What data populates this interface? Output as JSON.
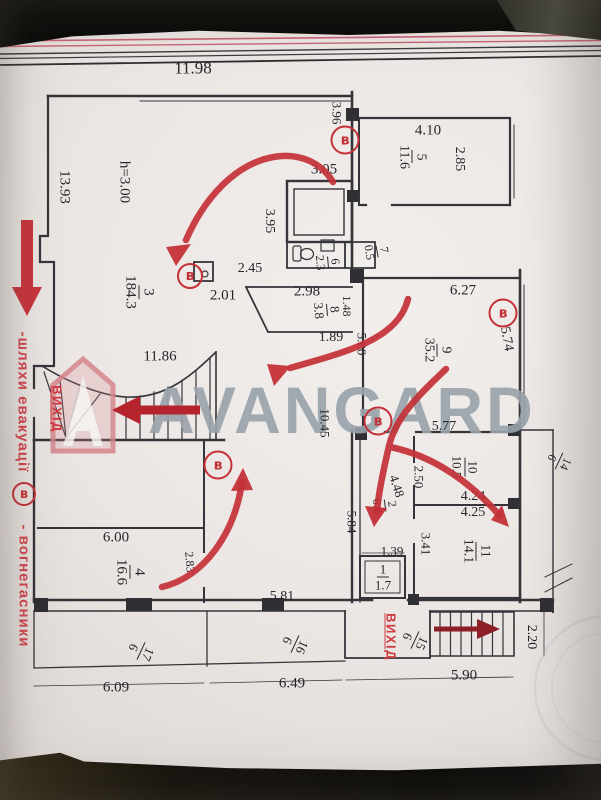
{
  "watermark": {
    "brand": "AVANGARD"
  },
  "legend": {
    "route_label": "-шляхи  евакуації",
    "extinguisher_symbol": "в",
    "extinguisher_label": "- вогнегасники"
  },
  "exit_labels": [
    {
      "text": "ВИХІД",
      "x": 57,
      "y": 409,
      "r": 90,
      "fs": 13
    },
    {
      "text": "ВИХІД",
      "x": 391,
      "y": 637,
      "r": 90,
      "fs": 13
    }
  ],
  "extinguisher_marks": [
    {
      "symbol": "в",
      "x": 345,
      "y": 140,
      "d": 25
    },
    {
      "symbol": "в",
      "x": 190,
      "y": 276,
      "d": 22
    },
    {
      "symbol": "в",
      "x": 503,
      "y": 313,
      "d": 25
    },
    {
      "symbol": "в",
      "x": 378,
      "y": 421,
      "d": 25
    },
    {
      "symbol": "в",
      "x": 218,
      "y": 465,
      "d": 25
    }
  ],
  "room_labels": [
    {
      "num": "1",
      "area": "1.7",
      "x": 383,
      "y": 577,
      "r": 0,
      "fs": 13
    },
    {
      "num": "2",
      "area": "6.2",
      "x": 385,
      "y": 505,
      "r": 82,
      "fs": 12
    },
    {
      "num": "3",
      "area": "184.3",
      "x": 139,
      "y": 292,
      "r": 90,
      "fs": 15
    },
    {
      "num": "4",
      "area": "16.6",
      "x": 130,
      "y": 572,
      "r": 90,
      "fs": 15
    },
    {
      "num": "5",
      "area": "11.6",
      "x": 412,
      "y": 157,
      "r": 90,
      "fs": 14
    },
    {
      "num": "6",
      "area": "2.3",
      "x": 328,
      "y": 262,
      "r": 85,
      "fs": 12
    },
    {
      "num": "7",
      "area": "0.5",
      "x": 377,
      "y": 251,
      "r": 80,
      "fs": 12
    },
    {
      "num": "8",
      "area": "3.8",
      "x": 327,
      "y": 310,
      "r": 85,
      "fs": 13
    },
    {
      "num": "9",
      "area": "35.2",
      "x": 437,
      "y": 350,
      "r": 90,
      "fs": 14
    },
    {
      "num": "10",
      "area": "10.5",
      "x": 465,
      "y": 467,
      "r": 90,
      "fs": 13
    },
    {
      "num": "11",
      "area": "14.1",
      "x": 476,
      "y": 551,
      "r": 90,
      "fs": 14
    },
    {
      "num": "14",
      "area": "6",
      "x": 559,
      "y": 461,
      "r": 115,
      "fs": 12
    },
    {
      "num": "15",
      "area": "6",
      "x": 415,
      "y": 640,
      "r": 115,
      "fs": 13
    },
    {
      "num": "16",
      "area": "6",
      "x": 295,
      "y": 644,
      "r": 115,
      "fs": 13
    },
    {
      "num": "17",
      "area": "6",
      "x": 141,
      "y": 651,
      "r": 115,
      "fs": 13
    }
  ],
  "dimensions": [
    {
      "text": "11.98",
      "x": 193,
      "y": 68,
      "r": 0,
      "fs": 17
    },
    {
      "text": "3.96",
      "x": 337,
      "y": 113,
      "r": 90,
      "fs": 13
    },
    {
      "text": "4.10",
      "x": 428,
      "y": 131,
      "r": 0,
      "fs": 15
    },
    {
      "text": "2.85",
      "x": 459,
      "y": 159,
      "r": 90,
      "fs": 14
    },
    {
      "text": "3.05",
      "x": 324,
      "y": 170,
      "r": 0,
      "fs": 15
    },
    {
      "text": "3.95",
      "x": 269,
      "y": 221,
      "r": 90,
      "fs": 14
    },
    {
      "text": "13.93",
      "x": 64,
      "y": 187,
      "r": 90,
      "fs": 15
    },
    {
      "text": "h=3.00",
      "x": 124,
      "y": 182,
      "r": 90,
      "fs": 15
    },
    {
      "text": "2.45",
      "x": 250,
      "y": 269,
      "r": 0,
      "fs": 14
    },
    {
      "text": "2.01",
      "x": 223,
      "y": 296,
      "r": 0,
      "fs": 15
    },
    {
      "text": "2.98",
      "x": 307,
      "y": 292,
      "r": 0,
      "fs": 15
    },
    {
      "text": "1.48",
      "x": 347,
      "y": 306,
      "r": 90,
      "fs": 12
    },
    {
      "text": "1.89",
      "x": 331,
      "y": 338,
      "r": 0,
      "fs": 14
    },
    {
      "text": "5.00",
      "x": 362,
      "y": 344,
      "r": 90,
      "fs": 13
    },
    {
      "text": "6.27",
      "x": 463,
      "y": 291,
      "r": 0,
      "fs": 15
    },
    {
      "text": "5.74",
      "x": 506,
      "y": 339,
      "r": 80,
      "fs": 14
    },
    {
      "text": "11.86",
      "x": 160,
      "y": 357,
      "r": 0,
      "fs": 15
    },
    {
      "text": "10.45",
      "x": 325,
      "y": 423,
      "r": 90,
      "fs": 13
    },
    {
      "text": "5.77",
      "x": 444,
      "y": 427,
      "r": 0,
      "fs": 14
    },
    {
      "text": "2.50",
      "x": 419,
      "y": 477,
      "r": 90,
      "fs": 13
    },
    {
      "text": "4.48",
      "x": 397,
      "y": 486,
      "r": 72,
      "fs": 13
    },
    {
      "text": "4.24",
      "x": 473,
      "y": 497,
      "r": 0,
      "fs": 14
    },
    {
      "text": "4.25",
      "x": 473,
      "y": 513,
      "r": 0,
      "fs": 14
    },
    {
      "text": "3.41",
      "x": 426,
      "y": 544,
      "r": 90,
      "fs": 13
    },
    {
      "text": "5.84",
      "x": 352,
      "y": 522,
      "r": 90,
      "fs": 13
    },
    {
      "text": "6.00",
      "x": 116,
      "y": 538,
      "r": 0,
      "fs": 15
    },
    {
      "text": "2.83",
      "x": 190,
      "y": 562,
      "r": 85,
      "fs": 12
    },
    {
      "text": "1.39",
      "x": 392,
      "y": 551,
      "r": 0,
      "fs": 13
    },
    {
      "text": "5.81",
      "x": 282,
      "y": 597,
      "r": 0,
      "fs": 14
    },
    {
      "text": "6.09",
      "x": 116,
      "y": 688,
      "r": 0,
      "fs": 15
    },
    {
      "text": "6.49",
      "x": 292,
      "y": 684,
      "r": 0,
      "fs": 15
    },
    {
      "text": "5.90",
      "x": 464,
      "y": 676,
      "r": 0,
      "fs": 15
    },
    {
      "text": "2.20",
      "x": 531,
      "y": 637,
      "r": 90,
      "fs": 14
    }
  ],
  "colors": {
    "marker_red": "#c43138",
    "margin_text_red": "#d2474f",
    "dark_arrow_red": "#8c2026",
    "watermark_gray": "#99a2ab",
    "paper": "#ebe6e3",
    "line_black": "#34343a"
  }
}
